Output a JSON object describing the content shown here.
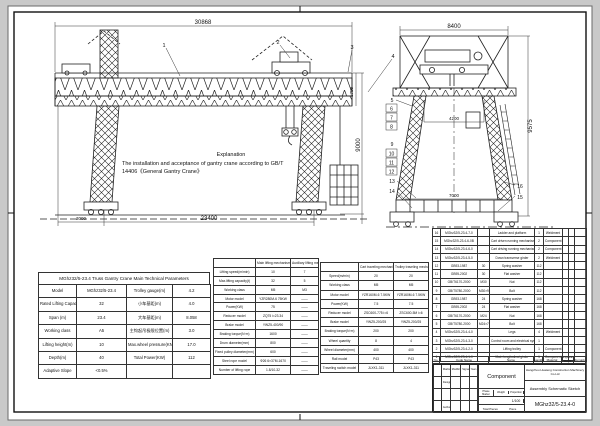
{
  "explanation": {
    "title": "Explanation",
    "line1": "The installation and acceptance of gantry crane according to GB/T",
    "line2": "14406《General Gantry Crane》"
  },
  "drawing": {
    "front": {
      "dim_top": "30868",
      "dim_right": "9000",
      "dim_depth": "1750",
      "dim_left": "3000",
      "dim_bottom": "23400"
    },
    "side": {
      "dim_top": "8400",
      "dim_center": "4200",
      "dim_bottom": "7000",
      "dim_right": "9575"
    },
    "callouts": {
      "c1": "1",
      "c2": "2",
      "c3": "3",
      "c4": "4",
      "c5": "5",
      "c6": "6",
      "c7": "7",
      "c8": "8",
      "c9": "9",
      "c10": "10",
      "c11": "11",
      "c12": "12",
      "c13": "13",
      "c14": "14",
      "c15": "15",
      "c16": "16"
    }
  },
  "param_table": {
    "title": "MGhz32/5-23.4 Truss Gantry Crane Main Technical Parameters",
    "rows": [
      [
        "Model",
        "MGhz32/5-23.4",
        "Trolley gauge(m)",
        "4.2"
      ],
      [
        "Rated Lifting Capacity(t)",
        "32",
        "小车基距(m)",
        "4.0"
      ],
      [
        "Span (m)",
        "23.4",
        "大车基距(m)",
        "8.058"
      ],
      [
        "Working class",
        "A5",
        "主钩起吊极限位置(m)",
        "3.0"
      ],
      [
        "Lifting height(m)",
        "10",
        "Max.wheel pressure(KN)",
        "17.0"
      ],
      [
        "Depth(m)",
        "40",
        "Total Power(KW)",
        "112"
      ],
      [
        "Adaptive Slope",
        "<0.5%",
        "",
        ""
      ]
    ]
  },
  "lift_table": {
    "rows": [
      [
        "",
        "Main lifting mechanism",
        "Auxiliary lifting mechanism"
      ],
      [
        "Lifting speed(m/min)",
        "10",
        "7"
      ],
      [
        "Max.lifting capacity(t)",
        "32",
        "5"
      ],
      [
        "Working class",
        "M5",
        "M3"
      ],
      [
        "Motor model",
        "YZR280M-6 75KW",
        "——"
      ],
      [
        "Power(KW)",
        "75",
        "——"
      ],
      [
        "Reducer model",
        "ZQ75 i=23.34",
        "——"
      ],
      [
        "Brake model",
        "YWZ5-400/90",
        "——"
      ],
      [
        "Braking torque(N·m)",
        "1600",
        "——"
      ],
      [
        "Drum diameter(mm)",
        "800",
        "——"
      ],
      [
        "Fixed pulley diameter(mm)",
        "600",
        "——"
      ],
      [
        "Steel rope model",
        "Φ26 6×37M-1670",
        "——"
      ],
      [
        "Number of lifting rope",
        "1.8/10-32",
        "——"
      ]
    ]
  },
  "travel_table": {
    "rows": [
      [
        "",
        "Cart traveling mechanism",
        "Trolley traveling mechanism"
      ],
      [
        "Speed(m/min)",
        "20",
        "20"
      ],
      [
        "Working class",
        "M5",
        "M5"
      ],
      [
        "Motor model",
        "YZR160M-6 7.5KW",
        "YZR160M-6 7.5KW"
      ],
      [
        "Power(KW)",
        "7.5",
        "7.5"
      ],
      [
        "Reducer model",
        "ZSC600-775 i=6",
        "ZSC600-5M i=6"
      ],
      [
        "Brake model",
        "YWZ5-200/25",
        "YWZ5-200/25"
      ],
      [
        "Braking torque(N·m)",
        "200",
        "200"
      ],
      [
        "Wheel quantity",
        "8",
        "4"
      ],
      [
        "Wheel diameter(mm)",
        "400",
        "400"
      ],
      [
        "Rail model",
        "P43",
        "P43"
      ],
      [
        "Traveling switch model",
        "JLXK1-311",
        "JLXK1-311"
      ]
    ]
  },
  "bom": {
    "header": {
      "no": "No.",
      "code": "Code Name",
      "name": "Name",
      "qty": "Quantity",
      "material": "Material",
      "single": "Single Piece",
      "total": "Total",
      "weight": "Weight",
      "remark": "Remark"
    },
    "rows": [
      [
        "16",
        "MGhz32/5-23.4-7-0",
        "",
        "Ladder and platform",
        "1",
        "Weldment",
        "",
        "",
        ""
      ],
      [
        "15",
        "MGhz32/5-23.4-6-0B",
        "",
        "Cart driven running mechanism",
        "2",
        "Component",
        "",
        "",
        ""
      ],
      [
        "14",
        "MGhz32/5-23.4-6-0",
        "",
        "Cart driving running mechanism",
        "2",
        "Component",
        "",
        "",
        ""
      ],
      [
        "13",
        "MGhz32/5-23.4-5-0",
        "",
        "Down transverse girder",
        "2",
        "Weldment",
        "",
        "",
        ""
      ],
      [
        "12",
        "GB93-1987",
        "30",
        "Spring washer",
        "112",
        "",
        "",
        "",
        ""
      ],
      [
        "11",
        "GB95-2002",
        "30",
        "Flat washer",
        "112",
        "",
        "",
        "",
        ""
      ],
      [
        "10",
        "GB/T6170-2000",
        "M30",
        "Nut",
        "112",
        "",
        "",
        "",
        ""
      ],
      [
        "9",
        "GB/T5780-2000",
        "M30×90",
        "Bolt",
        "112",
        "",
        "",
        "",
        ""
      ],
      [
        "8",
        "GB93-1987",
        "24",
        "Spring washer",
        "168",
        "",
        "",
        "",
        ""
      ],
      [
        "7",
        "GB95-2002",
        "24",
        "Flat washer",
        "168",
        "",
        "",
        "",
        ""
      ],
      [
        "6",
        "GB/T6170-2000",
        "M24",
        "Nut",
        "168",
        "",
        "",
        "",
        ""
      ],
      [
        "5",
        "GB/T5780-2000",
        "M24×70",
        "Bolt",
        "168",
        "",
        "",
        "",
        ""
      ],
      [
        "4",
        "MGhz32/5-23.4-4-0",
        "",
        "Legs",
        "4",
        "Weldment",
        "",
        "",
        ""
      ],
      [
        "3",
        "MGhz32/5-23.4-3-0",
        "",
        "Control room and electrical system",
        "1",
        "",
        "",
        "",
        ""
      ],
      [
        "2",
        "MGhz32/5-23.4-2-0",
        "",
        "Lifting trolley",
        "1",
        "Component",
        "",
        "",
        ""
      ],
      [
        "1",
        "MGhz32/5-23.4-1-0",
        "",
        "Main longitudinal girder",
        "1",
        "Component",
        "",
        "",
        ""
      ]
    ]
  },
  "title_block": {
    "company": "Hangzhou Huateng Construction Machinery Co.Ltd",
    "doc_type": "Component",
    "sheet_name": "Assembly Schematic Sketch",
    "drawing_no": "MGhz32/5-23.4-0",
    "scale": "1/100",
    "phase": "Phase Marker",
    "weight": "Weight",
    "proportion": "Proportion",
    "total_pieces": "Total Pieces",
    "piece": "Piece",
    "left_rows": [
      [
        "",
        "Marks",
        "Modification",
        "Signature",
        "Year-Month-Day"
      ],
      [
        "",
        "Designed",
        "",
        "",
        ""
      ],
      [
        "",
        "",
        "",
        "",
        ""
      ],
      [
        "",
        "Authorize",
        "",
        "",
        ""
      ]
    ]
  }
}
